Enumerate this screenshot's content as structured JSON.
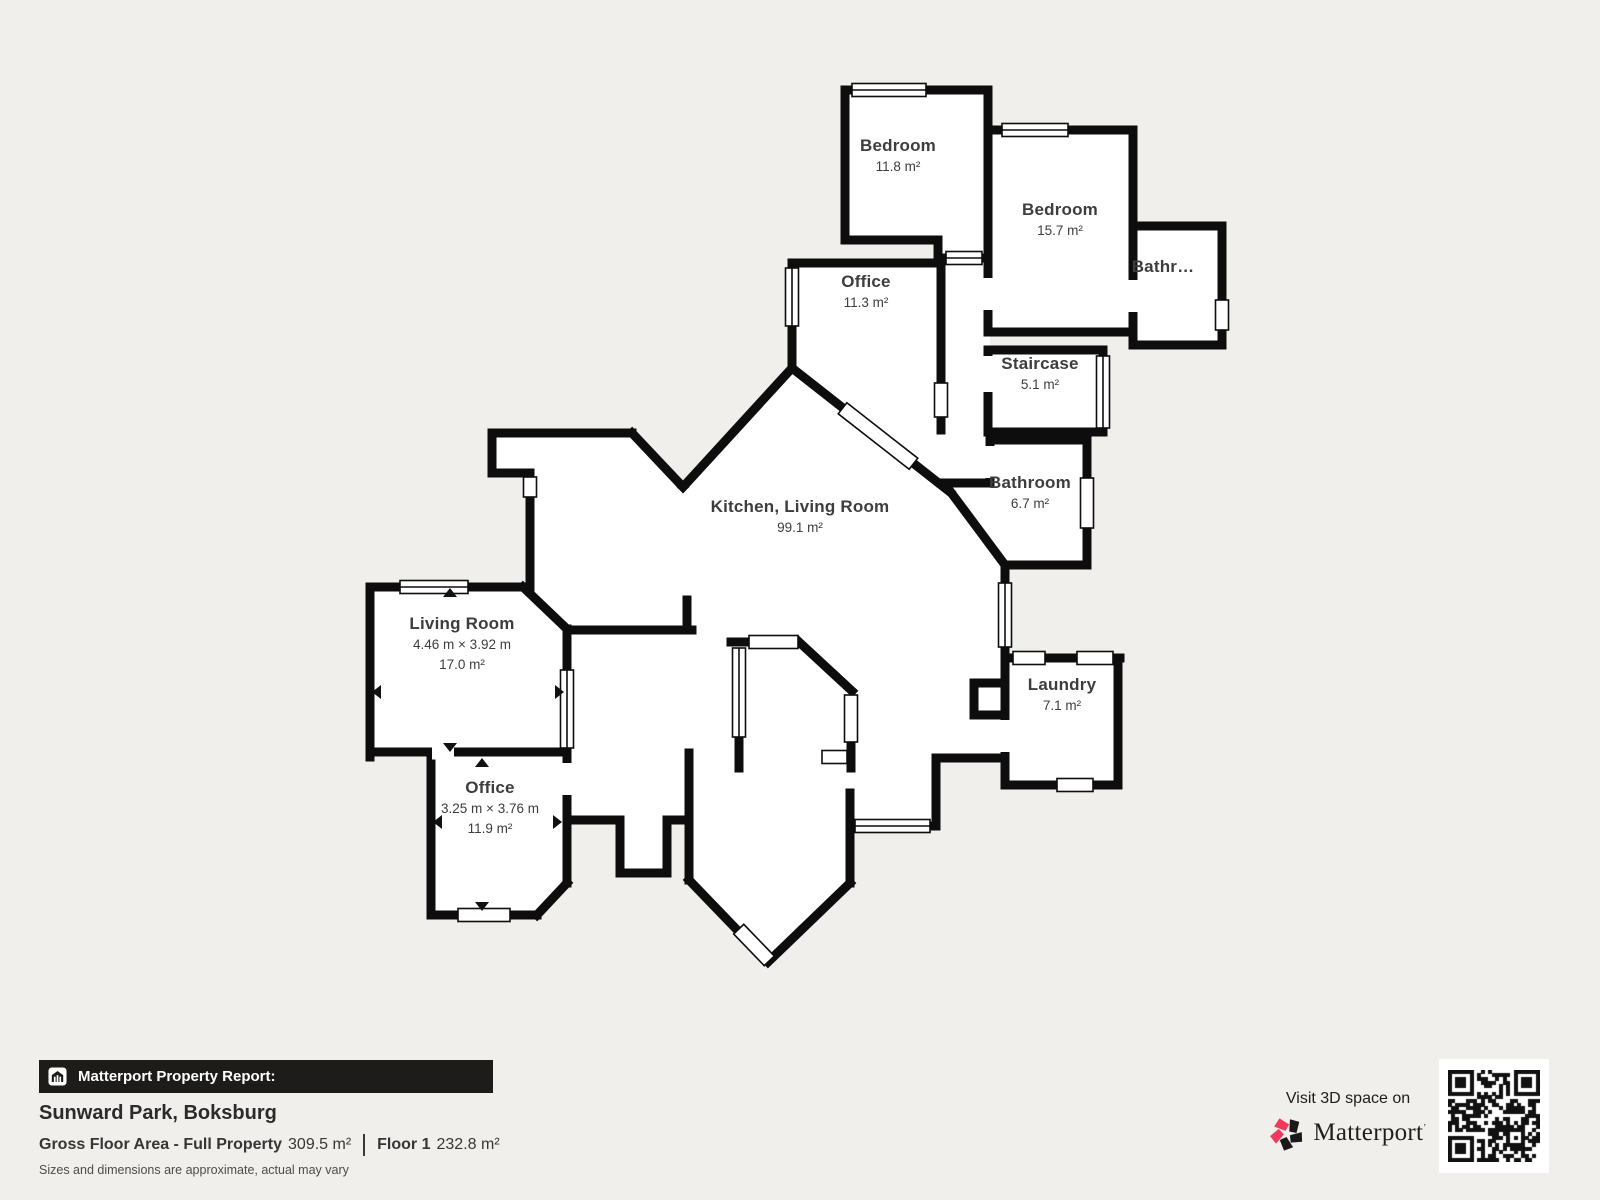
{
  "plan": {
    "rooms": [
      {
        "name": "Bedroom",
        "area": "11.8 m²"
      },
      {
        "name": "Bedroom",
        "area": "15.7 m²"
      },
      {
        "name": "Bathr…"
      },
      {
        "name": "Office",
        "area": "11.3 m²"
      },
      {
        "name": "Staircase",
        "area": "5.1 m²"
      },
      {
        "name": "Bathroom",
        "area": "6.7 m²"
      },
      {
        "name": "Kitchen, Living Room",
        "area": "99.1 m²"
      },
      {
        "name": "Living Room",
        "dimensions": "4.46 m × 3.92 m",
        "area": "17.0 m²"
      },
      {
        "name": "Office",
        "dimensions": "3.25 m × 3.76 m",
        "area": "11.9 m²"
      },
      {
        "name": "Laundry",
        "area": "7.1 m²"
      }
    ]
  },
  "footer": {
    "report_label": "Matterport Property Report:",
    "property_name": "Sunward Park, Boksburg",
    "gfa_label": "Gross Floor Area - Full Property",
    "gfa_value": "309.5 m²",
    "floor_label": "Floor 1",
    "floor_value": "232.8 m²",
    "disclaimer": "Sizes and dimensions are approximate, actual may vary"
  },
  "branding": {
    "visit_text": "Visit 3D space on",
    "brand_name": "Matterport",
    "brand_mark": "’",
    "qr_icon": "qr-code",
    "colors": {
      "pink": "#ef3a5e",
      "dark": "#1a1a1a",
      "walls": "#0d0d0d",
      "background": "#f1efec"
    }
  }
}
